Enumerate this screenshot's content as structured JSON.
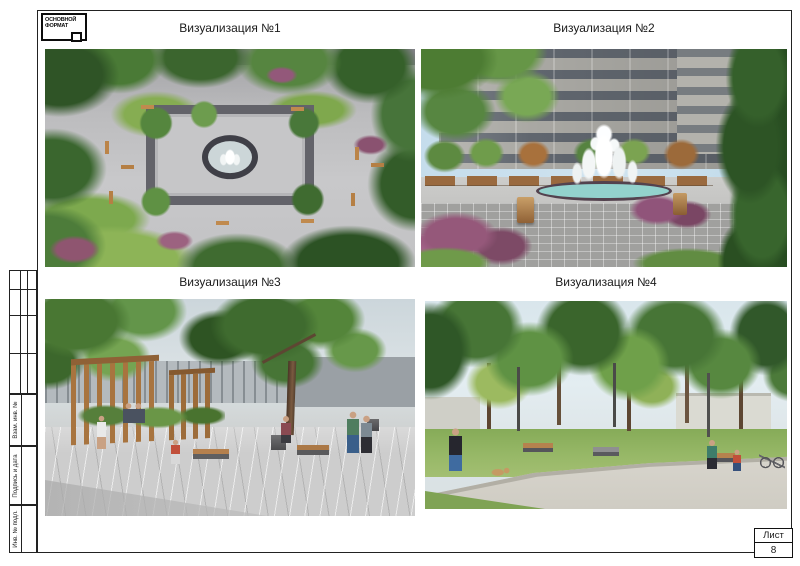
{
  "logo": {
    "line1": "ОСНОВНОЙ",
    "line2": "ФОРМАТ"
  },
  "visualizations": [
    {
      "caption": "Визуализация №1",
      "scene": "aerial view of square plaza with central fountain, trees and benches"
    },
    {
      "caption": "Визуализация №2",
      "scene": "ground-level view of fountain with apartment building behind"
    },
    {
      "caption": "Визуализация №3",
      "scene": "plaza with wooden pergolas, large tree and people"
    },
    {
      "caption": "Визуализация №4",
      "scene": "park path with trees, benches, people and a dog"
    }
  ],
  "title_block": {
    "side_labels": [
      {
        "label": "Взам. инв. №"
      },
      {
        "label": "Подпись и дата"
      },
      {
        "label": "Инв. № подл."
      }
    ],
    "sheet_label": "Лист",
    "sheet_number": "8"
  },
  "palette": {
    "paper": "#ffffff",
    "frame_line": "#222222",
    "caption_text": "#1b1b1b",
    "foliage_dark": "#2f5727",
    "foliage_mid": "#5f9144",
    "foliage_light": "#8db457",
    "paving_light": "#c9c9c9",
    "paving_dark": "#9e9e9c",
    "wood": "#a8743f",
    "water": "#93d2cd",
    "bush_purple": "#95587a",
    "sky": "#cfe3ef"
  }
}
